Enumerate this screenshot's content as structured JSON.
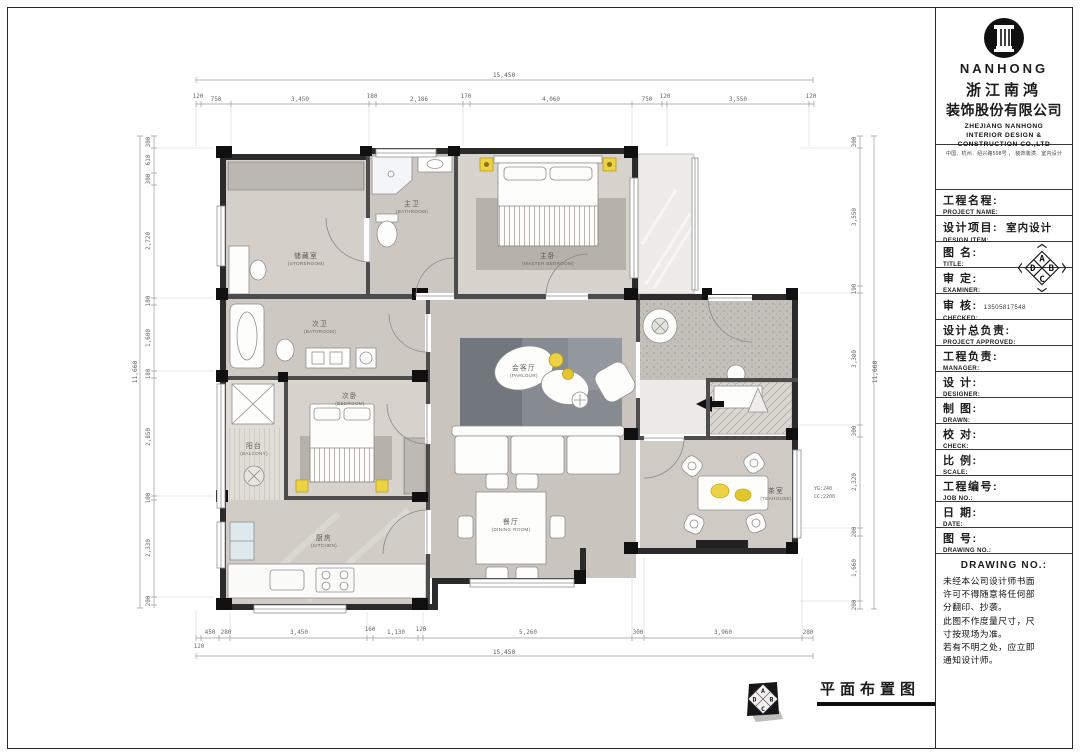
{
  "title_block": {
    "logo": {
      "brand": "NANHONG",
      "icon": "column-icon"
    },
    "company_cn_1": "浙江南鸿",
    "company_cn_2": "装饰股份有限公司",
    "company_en_1": "ZHEJIANG NANHONG",
    "company_en_2": "INTERIOR DESIGN &",
    "company_en_3": "CONSTRUCTION CO.,LTD",
    "address": "中国．杭州．绍兴路598号 ， 装饰装潢．室内设计",
    "fields": [
      {
        "cn": "工程名程:",
        "en": "PROJECT NAME:",
        "value": ""
      },
      {
        "cn": "设计项目:",
        "en": "DESIGN ITEM:",
        "value": "室内设计"
      },
      {
        "cn": "图  名:",
        "en": "TITLE:",
        "value": ""
      },
      {
        "cn": "审  定:",
        "en": "EXAMINER:",
        "value": ""
      },
      {
        "cn": "审  核:",
        "en": "CHECKED:",
        "value": "13505817548"
      },
      {
        "cn": "设计总负责:",
        "en": "PROJECT APPROVED:",
        "value": ""
      },
      {
        "cn": "工程负责:",
        "en": "MANAGER:",
        "value": ""
      },
      {
        "cn": "设  计:",
        "en": "DESIGNER:",
        "value": ""
      },
      {
        "cn": "制  图:",
        "en": "DRAWN:",
        "value": ""
      },
      {
        "cn": "校  对:",
        "en": "CHECK:",
        "value": ""
      },
      {
        "cn": "比  例:",
        "en": "SCALE:",
        "value": ""
      },
      {
        "cn": "工程编号:",
        "en": "JOB NO.:",
        "value": ""
      },
      {
        "cn": "日  期:",
        "en": "DATE:",
        "value": ""
      },
      {
        "cn": "图  号:",
        "en": "DRAWING NO.:",
        "value": ""
      }
    ],
    "compass": {
      "top": "A",
      "right": "B",
      "bottom": "C",
      "left": "D"
    },
    "notice_title": "DRAWING NO.:",
    "notice_lines": [
      "未经本公司设计师书面",
      "许可不得随意将任何部",
      "分翻印、抄袭。",
      "此图不作度量尺寸，尺",
      "寸按现场为准。",
      "若有不明之处，应立即",
      "通知设计师。"
    ]
  },
  "footer": {
    "drawing_title": "平面布置图",
    "compass": {
      "top": "A",
      "right": "B",
      "bottom": "C",
      "left": "D"
    }
  },
  "plan": {
    "rooms": {
      "storage": {
        "cn": "储藏室",
        "en": "(STOREROOM)"
      },
      "master_bath": {
        "cn": "主卫",
        "en": "(BATHROOM)"
      },
      "master_bed": {
        "cn": "主卧",
        "en": "(MASTER BEDROOM)"
      },
      "second_bath": {
        "cn": "次卫",
        "en": "(BATHROOM)"
      },
      "balcony": {
        "cn": "阳台",
        "en": "(BALCONY)"
      },
      "second_bed": {
        "cn": "次卧",
        "en": "(BEDROOM)"
      },
      "parlour": {
        "cn": "会客厅",
        "en": "(PARLOUR)"
      },
      "dining": {
        "cn": "餐厅",
        "en": "(DINING ROOM)"
      },
      "kitchen": {
        "cn": "厨房",
        "en": "(KITCHEN)"
      },
      "tea": {
        "cn": "茶室",
        "en": "(TEAHOUSE)"
      }
    },
    "annotation": {
      "line1": "YG:240",
      "line2": "CC:2200"
    },
    "dims": {
      "top_overall": "15,450",
      "top": [
        "120",
        "750",
        "3,450",
        "180",
        "2,186",
        "170",
        "4,060",
        "750",
        "120",
        "3,550",
        "120"
      ],
      "bottom": [
        "120",
        "450",
        "280",
        "3,450",
        "160",
        "1,130",
        "120",
        "5,260",
        "300",
        "3,960",
        "280"
      ],
      "bottom_overall": "15,450",
      "left_overall": "11,660",
      "left": [
        "300",
        "610",
        "300",
        "2,720",
        "180",
        "1,600",
        "180",
        "2,850",
        "100",
        "2,330",
        "200"
      ],
      "right_overall": "11,660",
      "right": [
        "300",
        "3,550",
        "190",
        "3,380",
        "300",
        "2,320",
        "200",
        "1,660",
        "200"
      ]
    }
  }
}
